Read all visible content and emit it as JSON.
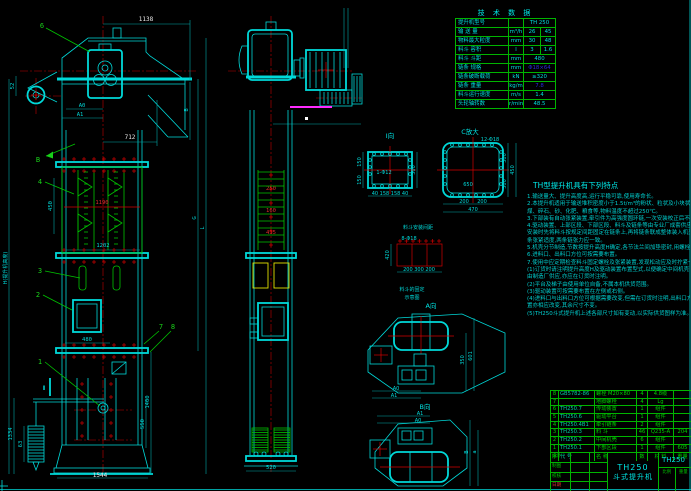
{
  "page": {
    "background": "#000000",
    "line_cyan": "#00d9d9",
    "line_green": "#00c400",
    "line_red": "#d40000",
    "line_yellow": "#e0e000",
    "line_magenta": "#ff2bff",
    "text_blue": "#2a2ad8"
  },
  "left_view": {
    "balloons": {
      "b1": "1",
      "b2": "2",
      "b3": "3",
      "b4": "4",
      "b6": "6",
      "b7": "7",
      "b8": "8"
    },
    "view_arrow_b": "B",
    "section_mark": "Ⅱ",
    "dims": {
      "total_width": "1138",
      "head_width": "712",
      "a0": "A0",
      "a1": "A1",
      "d52": "52",
      "side_b": "B",
      "g": "G",
      "l": "L",
      "h": "H(提升机高度)",
      "d450": "450",
      "d1190": "1190",
      "d1202": "1202",
      "d480": "480",
      "d1400": "1400",
      "d550": "550",
      "d1334": "1334",
      "d63": "63",
      "base_width": "1544"
    }
  },
  "middle_view": {
    "dims": {
      "d250": "250",
      "d160": "160",
      "d435": "435",
      "d520": "520"
    }
  },
  "details": {
    "flange_i": {
      "label": "Ⅰ向",
      "hole_note": "1-Φ12",
      "left_top": "150",
      "left_bottom": "150",
      "right": "300",
      "bottom": "40 158 158 40"
    },
    "flange_c": {
      "label": "C放大",
      "hole_note": "12-Φ18",
      "inner": "650",
      "right_top": "300",
      "right_bottom": "300",
      "right_total": "450",
      "bottom_left": "200",
      "bottom_right": "200",
      "bottom_total": "470"
    },
    "bucket_pitch": {
      "label": "料斗安装间距",
      "hole_note": "8-Φ18",
      "height": "420",
      "bottom": "200 300 200",
      "note_line1": "料斗的固定",
      "note_line2": "示意图"
    },
    "view_a": {
      "label": "A向",
      "a0": "A0",
      "a1": "A1",
      "d350": "350",
      "d601": "601"
    },
    "view_b": {
      "label": "B向",
      "a0": "A0",
      "a1": "A1",
      "db": "B",
      "da": "a"
    }
  },
  "tech_table": {
    "title": "技 术 数 据",
    "rows": [
      {
        "label": "提升机型号",
        "unit": "",
        "v1": "TH 250",
        "v2": "",
        "span": true
      },
      {
        "label": "输 送 量",
        "unit": "m³/h",
        "v1": "26",
        "v2": "45"
      },
      {
        "label": "物料最大粒度",
        "unit": "mm",
        "v1": "30",
        "v2": "48"
      },
      {
        "label": "料斗 容积",
        "unit": "l",
        "v1": "3",
        "v2": "1.6"
      },
      {
        "label": "料斗 斗距",
        "unit": "mm",
        "v1": "480",
        "v2": "",
        "span2": true
      },
      {
        "label": "链条 规格",
        "unit": "mm",
        "v1": "Φ18×64",
        "v2": "",
        "span2": true,
        "muted": true
      },
      {
        "label": "链条破断载荷",
        "unit": "kN",
        "v1": "≥320",
        "v2": "",
        "span2": true
      },
      {
        "label": "链条 重量",
        "unit": "kg/m",
        "v1": "7.8",
        "v2": "",
        "span2": true,
        "muted": true
      },
      {
        "label": "料斗运行速度",
        "unit": "m/s",
        "v1": "1.4",
        "v2": "",
        "span2": true
      },
      {
        "label": "头轮轴转数",
        "unit": "r/min",
        "v1": "48.5",
        "v2": "",
        "span2": true
      }
    ]
  },
  "notes": {
    "heading": "TH型提升机具有下列特点",
    "lines": [
      "1.输送量大、提升高度高,运行平稳可靠,使用寿命长。",
      "2.本提升机适用于输送堆积密度小于1.5t/m³的粉状、粒状及小块状无磨琢性、半磨琢性物料,如水泥、",
      "  煤、碎石、砂、化肥、粮食等,物料温度不超过250℃。",
      "3.下部装有自动张紧装置,牵引件为高强度圆环链,一次安装校正后不需经常调整,工作可靠。",
      "4.驱动装置、上部区段、下部区段、料斗及链条等由专业厂成套供应,中间机壳由使用单位按本图自制,",
      "  安装时先将料斗按规定间距固定在链条上,再将链条联成整体装入机壳内,最后调整张紧装置,使链",
      "  条张紧适度,两条链张力应一致。",
      "5.机壳分节制造,节数按提升高度H确定,各节法兰间加垫密封,用螺栓联接。",
      "6.进料口、出料口方位可按需要布置。",
      "7.使用中应定期检查料斗固定螺栓及张紧装置,发现松动应及时拧紧一次",
      "",
      "(1)订货时请注明提升高度H及驱动装置布置型式,以便确定中间机壳节数及供货范围,机壳如需",
      "   由制造厂供应,亦应在订货时注明。",
      "(2)平台及梯子由使用单位自备,不属本机供货范围。",
      "(3)驱动装置可按需要布置在左侧或右侧。",
      "(4)进料口与出料口方位可根据需要改变,但需在订货时注明,出料口方位与本图相反时,驱动装",
      "   置亦相应改变,其余尺寸不变。",
      "",
      "(5)TH250斗式提升机上述各部尺寸如有变动,以实际供货图样为准。"
    ]
  },
  "bom": {
    "header": {
      "no": "序",
      "code": "代  号",
      "name": "名  称",
      "qty": "数",
      "mat": "材  料",
      "wt": "重量"
    },
    "rows": [
      {
        "no": "8",
        "code": "GB5782-86",
        "name": "螺栓 M20×80",
        "qty": "4",
        "mat": "4.8级",
        "wt": ""
      },
      {
        "no": "7",
        "code": "",
        "name": "地脚螺栓",
        "qty": "4",
        "mat": "Lg",
        "wt": ""
      },
      {
        "no": "6",
        "code": "TH250.7",
        "name": "传动装置",
        "qty": "1",
        "mat": "组件",
        "wt": ""
      },
      {
        "no": "5",
        "code": "TH250.6",
        "name": "驱动平台",
        "qty": "1",
        "mat": "组件",
        "wt": ""
      },
      {
        "no": "4",
        "code": "TH250.4B1",
        "name": "牵引链条",
        "qty": "2",
        "mat": "组件",
        "wt": ""
      },
      {
        "no": "3",
        "code": "TH250.3",
        "name": "料  斗",
        "qty": "46",
        "mat": "Q235-A",
        "wt": "204"
      },
      {
        "no": "2",
        "code": "TH250.2",
        "name": "中间机壳",
        "qty": "6",
        "mat": "组件",
        "wt": ""
      },
      {
        "no": "1",
        "code": "TH250.1",
        "name": "下部区段",
        "qty": "1",
        "mat": "组件",
        "wt": "605"
      }
    ]
  },
  "title_block": {
    "model": "TH250",
    "product_name": "斗式提升机",
    "drawing_no": "TH250",
    "left_rows": [
      {
        "label": "设计",
        "red": false
      },
      {
        "label": "制图",
        "red": false
      },
      {
        "label": "校核",
        "red": false
      },
      {
        "label": "日期",
        "red": true
      }
    ],
    "scale_label": "比例",
    "weight_label": "重量"
  }
}
